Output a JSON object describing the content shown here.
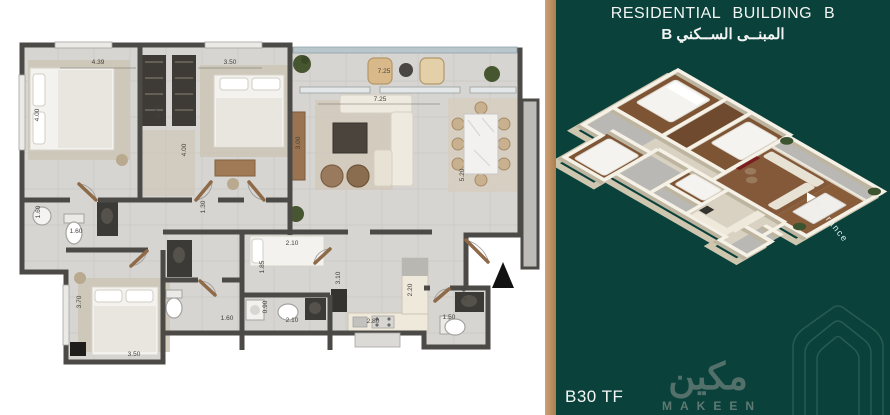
{
  "panel": {
    "title_en": "RESIDENTIAL BUILDING B",
    "title_ar": "المبنــى الســكني B",
    "unit_code": "B30 TF",
    "entrance_label": "Entrance",
    "brand": {
      "arabic": "مكين",
      "latin": "MAKEEN"
    },
    "colors": {
      "background_green": "#0a423b",
      "gold_strip": "#bf9267",
      "logo_green": "#5d7a72",
      "wall_gray": "#4c4a46",
      "wood_brown": "#9a7352"
    }
  },
  "plan": {
    "entrance_marker": "▲",
    "dims": [
      {
        "value": "4.39"
      },
      {
        "value": "3.50"
      },
      {
        "value": "4.00"
      },
      {
        "value": "4.00"
      },
      {
        "value": "0.70"
      },
      {
        "value": "7.25"
      },
      {
        "value": "7.25"
      },
      {
        "value": "3.00"
      },
      {
        "value": "5.20"
      },
      {
        "value": "1.30"
      },
      {
        "value": "1.60"
      },
      {
        "value": "1.60"
      },
      {
        "value": "3.70"
      },
      {
        "value": "3.50"
      },
      {
        "value": "2.10"
      },
      {
        "value": "1.85"
      },
      {
        "value": "3.10"
      },
      {
        "value": "0.90"
      },
      {
        "value": "1.60"
      },
      {
        "value": "2.10"
      },
      {
        "value": "2.80"
      },
      {
        "value": "2.20"
      },
      {
        "value": "1.50"
      },
      {
        "value": "2.00"
      }
    ]
  }
}
